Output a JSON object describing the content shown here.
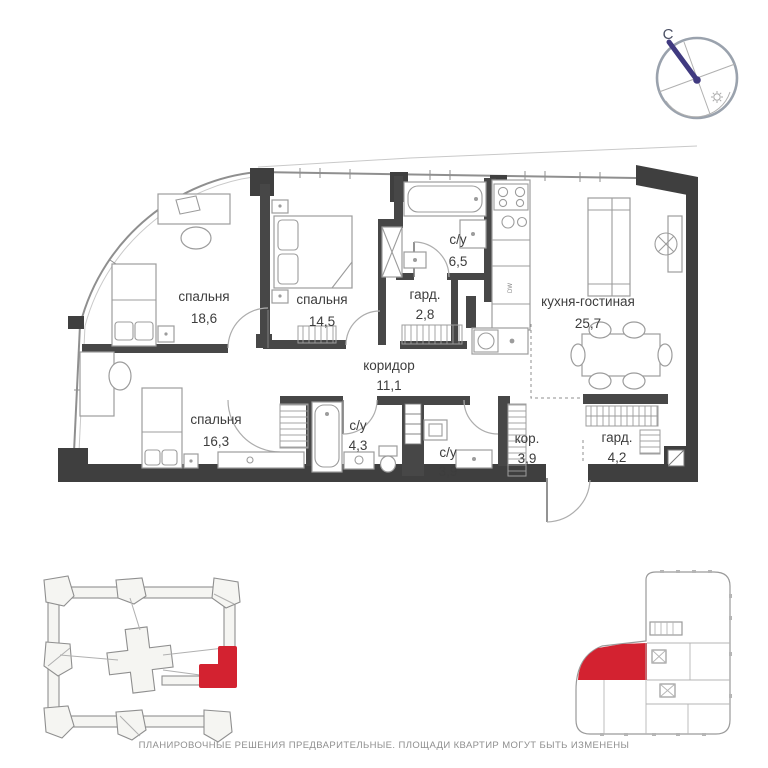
{
  "compass": {
    "north_label": "С"
  },
  "plan": {
    "rooms": [
      {
        "id": "bedroom-1",
        "name": "спальня",
        "area": "18,6"
      },
      {
        "id": "bedroom-2",
        "name": "спальня",
        "area": "14,5"
      },
      {
        "id": "wardrobe-1",
        "name": "гард.",
        "area": "2,8"
      },
      {
        "id": "bathroom-1",
        "name": "с/у",
        "area": "6,5"
      },
      {
        "id": "kitchen-living",
        "name": "кухня-гостиная",
        "area": "25,7"
      },
      {
        "id": "corridor",
        "name": "коридор",
        "area": "11,1"
      },
      {
        "id": "bedroom-3",
        "name": "спальня",
        "area": "16,3"
      },
      {
        "id": "bathroom-2",
        "name": "с/у",
        "area": "4,3"
      },
      {
        "id": "bathroom-3",
        "name": "с/у",
        "area": "3,9"
      },
      {
        "id": "hall",
        "name": "кор.",
        "area": "3,9"
      },
      {
        "id": "wardrobe-2",
        "name": "гард.",
        "area": "4,2"
      }
    ],
    "appliance_label": "DW"
  },
  "colors": {
    "accent_red": "#d32230",
    "wall_dark": "#3f3f3f",
    "needle_blue": "#403a80"
  },
  "footer": {
    "disclaimer": "ПЛАНИРОВОЧНЫЕ РЕШЕНИЯ ПРЕДВАРИТЕЛЬНЫЕ. ПЛОЩАДИ КВАРТИР МОГУТ БЫТЬ ИЗМЕНЕНЫ"
  }
}
